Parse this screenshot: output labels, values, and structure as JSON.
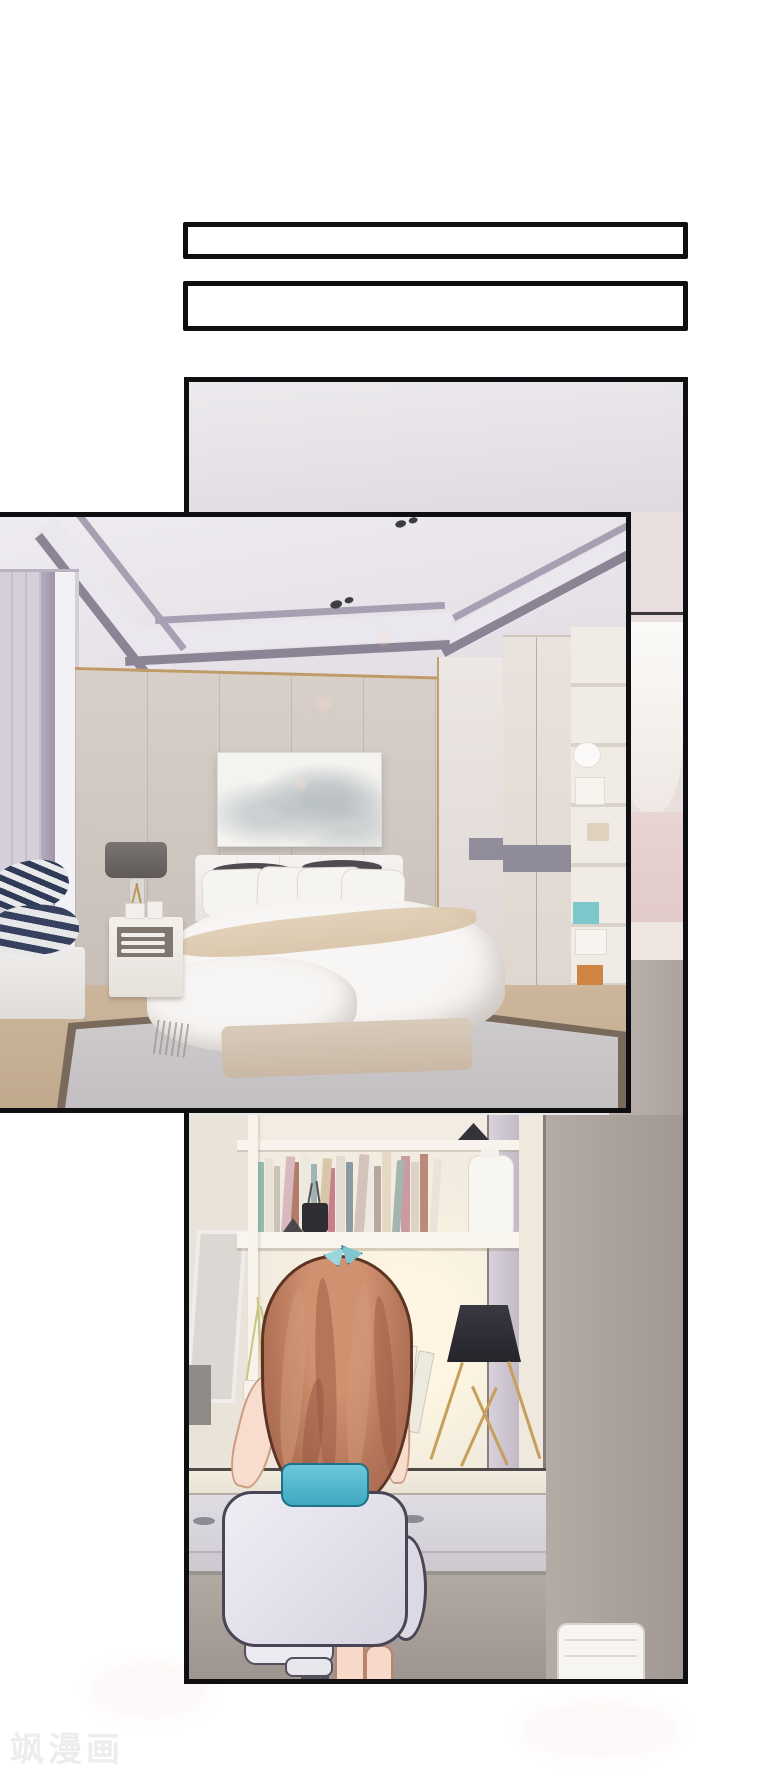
{
  "page": {
    "width": 760,
    "height": 1770,
    "background": "#ffffff"
  },
  "watermark": {
    "text": "飒漫画",
    "color": "#ededf0"
  },
  "speech_boxes": [
    {
      "text": ""
    },
    {
      "text": ""
    }
  ],
  "panels": {
    "border_color": "#0f0f12",
    "main": {
      "description": "drawn room scene with girl at vanity desk"
    },
    "photo": {
      "description": "rendered bedroom photo overlapping panel"
    }
  },
  "palette": {
    "hair": "#b5765a",
    "hair_outline": "#5d3423",
    "skin": "#f8dcce",
    "teal_accent": "#5fc6da",
    "chair": "#ddd9e4",
    "chair_outline": "#4a4554",
    "navy_stripe": "#2f3b57",
    "gold": "#c69f5b",
    "wall_taupe": "#b5aba5",
    "wall_cream": "#ece4da",
    "rug": "#c9c5c8",
    "rug_border": "#7a6a5b",
    "floor": "#c7b196",
    "lamp_black": "#2c2a30"
  },
  "desk_scene": {
    "book_spines": [
      {
        "c": "#8fbdb3",
        "h": 70,
        "w": 9
      },
      {
        "c": "#e7e1d6",
        "h": 74,
        "w": 8
      },
      {
        "c": "#c9c2b6",
        "h": 66,
        "w": 7
      },
      {
        "c": "#d8b9c0",
        "h": 76,
        "w": 9
      },
      {
        "c": "#b37d6b",
        "h": 70,
        "w": 8
      },
      {
        "c": "#eee9df",
        "h": 78,
        "w": 10
      },
      {
        "c": "#9fb3b8",
        "h": 68,
        "w": 7
      },
      {
        "c": "#d7c6a8",
        "h": 74,
        "w": 9
      },
      {
        "c": "#c77f8a",
        "h": 64,
        "w": 7
      },
      {
        "c": "#e2dcd2",
        "h": 76,
        "w": 9
      },
      {
        "c": "#8d9aa4",
        "h": 70,
        "w": 8
      },
      {
        "c": "#d2c3bb",
        "h": 78,
        "w": 10
      },
      {
        "c": "#efeae1",
        "h": 72,
        "w": 8
      },
      {
        "c": "#b8a7a0",
        "h": 66,
        "w": 7
      },
      {
        "c": "#e6d9c4",
        "h": 80,
        "w": 10
      },
      {
        "c": "#a3b5ae",
        "h": 72,
        "w": 8
      },
      {
        "c": "#cc9aa2",
        "h": 76,
        "w": 9
      },
      {
        "c": "#ddd3c5",
        "h": 70,
        "w": 8
      },
      {
        "c": "#b9897a",
        "h": 78,
        "w": 9
      },
      {
        "c": "#e9e4da",
        "h": 74,
        "w": 8
      }
    ]
  }
}
